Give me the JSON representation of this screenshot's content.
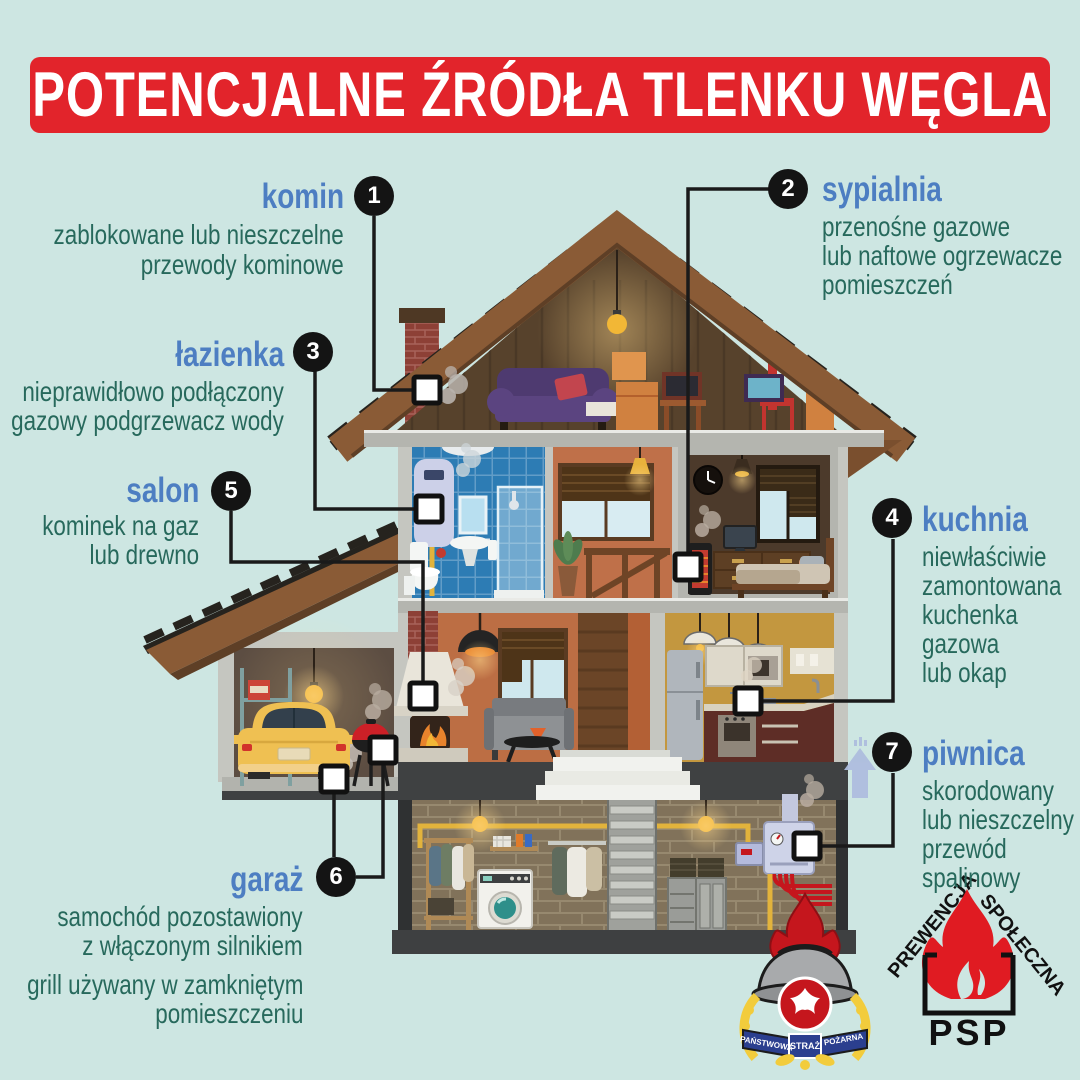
{
  "title": "POTENCJALNE ŹRÓDŁA TLENKU WĘGLA",
  "colors": {
    "background": "#cde6e2",
    "banner_red": "#e2242b",
    "heading_blue": "#4d7ec2",
    "body_teal": "#27695c",
    "callout_black": "#141414"
  },
  "annotations": {
    "komin": {
      "number": "1",
      "title": "komin",
      "line1": "zablokowane lub nieszczelne",
      "line2": "przewody kominowe"
    },
    "sypialnia": {
      "number": "2",
      "title": "sypialnia",
      "line1": "przenośne gazowe",
      "line2": "lub naftowe ogrzewacze",
      "line3": "pomieszczeń"
    },
    "lazienka": {
      "number": "3",
      "title": "łazienka",
      "line1": "nieprawidłowo podłączony",
      "line2": "gazowy podgrzewacz wody"
    },
    "kuchnia": {
      "number": "4",
      "title": "kuchnia",
      "line1": "niewłaściwie",
      "line2": "zamontowana",
      "line3": "kuchenka",
      "line4": "gazowa",
      "line5": "lub okap"
    },
    "salon": {
      "number": "5",
      "title": "salon",
      "line1": "kominek na gaz",
      "line2": "lub drewno"
    },
    "garaz": {
      "number": "6",
      "title": "garaż",
      "line1": "samochód pozostawiony",
      "line2": "z włączonym silnikiem",
      "line3": "grill używany w zamkniętym",
      "line4": "pomieszczeniu"
    },
    "piwnica": {
      "number": "7",
      "title": "piwnica",
      "line1": "skorodowany",
      "line2": "lub nieszczelny",
      "line3": "przewód",
      "line4": "spalinowy"
    }
  },
  "logos": {
    "psp_ribbon_left": "PAŃSTWOWA",
    "psp_ribbon_center": "STRAŻ",
    "psp_ribbon_right": "POŻARNA",
    "prevention_left": "PREWENCJA",
    "prevention_right": "SPOŁECZNA",
    "prevention_abbr": "PSP"
  }
}
